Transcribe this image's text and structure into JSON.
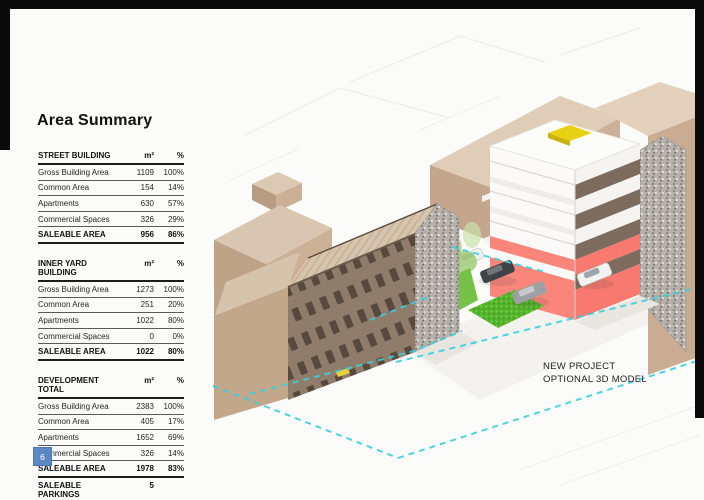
{
  "slide": {
    "title": "Area Summary",
    "page_number": "6",
    "note_line1": "NEW PROJECT",
    "note_line2": "OPTIONAL 3D MODEL"
  },
  "tables": [
    {
      "title": "STREET BUILDING",
      "unit": "m²",
      "pct": "%",
      "rows": [
        {
          "c": [
            "Gross Building Area",
            "1109",
            "100%"
          ]
        },
        {
          "c": [
            "Common Area",
            "154",
            "14%"
          ]
        },
        {
          "c": [
            "Apartments",
            "630",
            "57%"
          ]
        },
        {
          "c": [
            "Commercial Spaces",
            "326",
            "29%"
          ]
        },
        {
          "c": [
            "SALEABLE AREA",
            "956",
            "86%"
          ],
          "b": true
        }
      ]
    },
    {
      "title": "INNER YARD BUILDING",
      "unit": "m²",
      "pct": "%",
      "rows": [
        {
          "c": [
            "Gross Building Area",
            "1273",
            "100%"
          ]
        },
        {
          "c": [
            "Common Area",
            "251",
            "20%"
          ]
        },
        {
          "c": [
            "Apartments",
            "1022",
            "80%"
          ]
        },
        {
          "c": [
            "Commercial Spaces",
            "0",
            "0%"
          ]
        },
        {
          "c": [
            "SALEABLE AREA",
            "1022",
            "80%"
          ],
          "b": true
        }
      ]
    },
    {
      "title": "DEVELOPMENT TOTAL",
      "unit": "m²",
      "pct": "%",
      "rows": [
        {
          "c": [
            "Gross Building Area",
            "2383",
            "100%"
          ]
        },
        {
          "c": [
            "Common Area",
            "405",
            "17%"
          ]
        },
        {
          "c": [
            "Apartments",
            "1652",
            "69%"
          ]
        },
        {
          "c": [
            "Commercial Spaces",
            "326",
            "14%"
          ]
        },
        {
          "c": [
            "SALEABLE AREA",
            "1978",
            "83%"
          ],
          "b": true
        },
        {
          "c": [
            "SALEABLE PARKINGS",
            "5",
            ""
          ],
          "b": true
        }
      ]
    }
  ],
  "colors": {
    "boundary_dashes_cyan": "#3ad0dc",
    "new_building_red": "#f8796f",
    "new_building_band_brown": "#7d6b5e",
    "roof_marker_yellow": "#e8d114",
    "existing_building_beige": "#d9c6b0",
    "page_badge_blue": "#5b87c3"
  }
}
